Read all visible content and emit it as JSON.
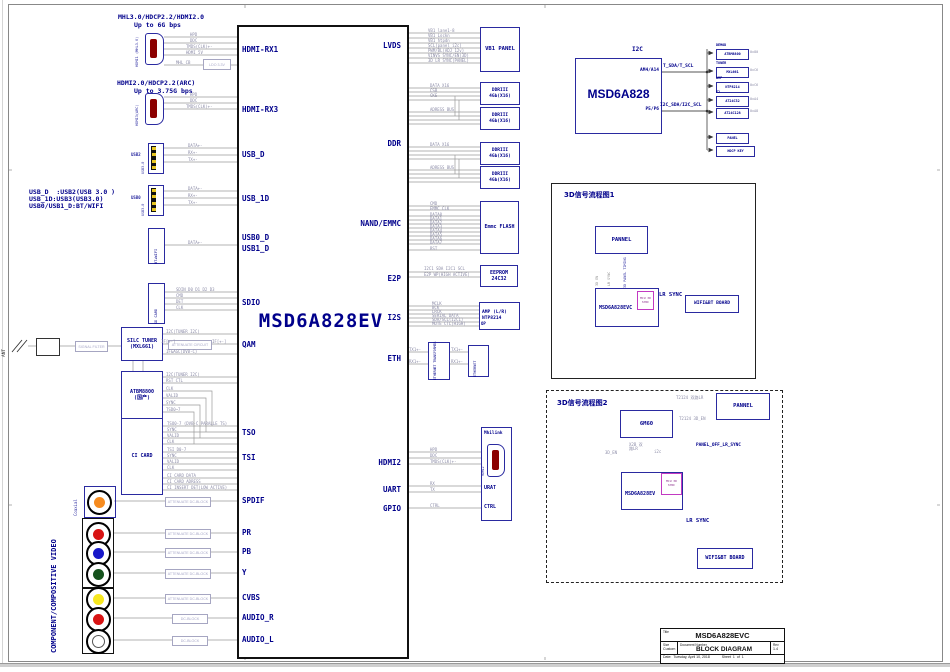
{
  "notes": {
    "mhl1": "MHL3.0/HDCP2.2/HDMI2.0",
    "mhl2": "Up to 6G bps",
    "arc1": "HDMI2.0/HDCP2.2(ARC)",
    "arc2": "Up to 3.75G bps",
    "usb1": "USB_D  :USB2(USB 3.0 )",
    "usb2": "USB_1D:USB3(USB3.0)",
    "usb3": "USB0/USB1_D:BT/WIFI",
    "component": "COMPONENT/COMPOSITIVE VIDEO",
    "coaxial": "Coaxial",
    "ant": "ANT"
  },
  "conn": {
    "hdmi1": "HDMI1 (MHL3.0)",
    "hdmi3": "HDMI3(ARC)",
    "usb2_tag": "USB2",
    "usb2_type": "USB3.0",
    "usb0_tag": "USB0",
    "usb0_type": "USB3.0",
    "btwifi": "BT+WIFI",
    "sdcard": "SD CARD"
  },
  "chip": {
    "label": "MSD6A828EV",
    "pins_left": [
      "HDMI-RX1",
      "HDMI-RX3",
      "USB_D",
      "USB_1D",
      "USB0_D",
      "USB1_D",
      "SDIO",
      "QAM",
      "TSO",
      "TSI",
      "SPDIF",
      "PR",
      "PB",
      "Y",
      "CVBS",
      "AUDIO_R",
      "AUDIO_L"
    ],
    "pins_right": [
      "LVDS",
      "DDR",
      "NAND/EMMC",
      "E2P",
      "I2S",
      "ETH",
      "HDMI2",
      "UART",
      "GPIO"
    ]
  },
  "lw": {
    "hdmi1": [
      "HPD",
      "DDC",
      "TMDS(CLK)+-",
      "HDMI_5V",
      "MHL_CB"
    ],
    "ldo": "LDO 3.3V",
    "hdmi3": [
      "HPD",
      "DDC",
      "TMDS(CLK)+-"
    ],
    "usb": [
      "DATA+-",
      "RX+-",
      "TX+-"
    ],
    "bt": "DATA+-",
    "sd": [
      "SDIN_D0 D1 D2 D3",
      "CMD",
      "DET",
      "CLK"
    ],
    "att": "ATTENUATE  DC-BLOCK",
    "dc": "DC-BLOCK"
  },
  "tuner": {
    "filter": "SIGNAL FILTER",
    "t1": "SILC TUNER",
    "t2": "(MXL661)",
    "d1": "ATBM8800",
    "d2": "(国产)",
    "ci": "CI CARD",
    "attc": "ATTENUATE CIRCUIT",
    "i2c": "I2C(TUNER I2C)",
    "if": "IF[+-]",
    "ifagc": "IF&AGC(DVB-C)",
    "rst": "RST CTL",
    "rows": [
      "CLK",
      "VALID",
      "SYNC",
      "TSD0~7"
    ],
    "tso": [
      "TSO0-7 (DVB-C PARALLE TS)",
      "SYNC",
      "VALID",
      "CLK"
    ],
    "tsi": [
      "TSI D0-7",
      "SYNC",
      "VALID",
      "CLK"
    ],
    "cic": [
      "CI CARD DATA",
      "CI CARD ADRESS",
      "CI INSERT DET(LOW ACTIVE)"
    ]
  },
  "rb": {
    "vb1": "VB1 PANEL",
    "vb1_rows": [
      "VB1 lane1-8",
      "VB1 Lockn",
      "VB1 htpdn",
      "SCL(panel i2c)",
      "PWM/BL(ADJ 12v)",
      "VINVS SYNC/EN(3D)",
      "3D LR SYNC(PANEL)"
    ],
    "ddr1": "DDRIII",
    "ddr2": "4Gb(X16)",
    "ddr_rows": [
      "DATA X16",
      "CSB",
      "CKE",
      "ADRESS BUS"
    ],
    "emmc": "Emmc FLASH",
    "emmc_rows": [
      "CMD",
      "EMMC CLK",
      "DATA0",
      "DATA1",
      "DATA2",
      "DATA3",
      "DATA4",
      "DATA5",
      "DATA6",
      "DATA7",
      "RST"
    ],
    "ee1": "EEPROM",
    "ee2": "24C32",
    "ee_rows": [
      "I2C1 SDA I2C1 SCL",
      "E2P WP(HIGH ACTIVE)"
    ],
    "amp1": "AMP (L/R)",
    "amp2": "NTP8214",
    "op": "OP",
    "amp_rows": [
      "MCLK",
      "BCK",
      "LRCK",
      "SERIAL DATA",
      "SDA/SCL(I2C1)",
      "MUTE CTL(HIGH)"
    ],
    "etr": "ETHERNET TRANSFORMER",
    "eth": "ETHERNET",
    "eth_tx": "TX1+-",
    "eth_rx": "RX1+-",
    "mhi": "Mhilink",
    "mhi_hdmi": "HDMI2",
    "urat": "URAT",
    "ctrl": "CTRL",
    "hdmi2_rows": [
      "HPD",
      "DDC",
      "TMDS(CLK)+-"
    ],
    "uart_rows": [
      "RX",
      "TX"
    ],
    "gpio_row": "CTRL"
  },
  "i2c": {
    "title": "I2C",
    "chip": "MSD6A828",
    "pin_a": "AM4/A14",
    "pin_b": "P5/P6",
    "bus_a": "T_SDA/T_SCL",
    "bus_b": "I2C_SDA/I2C_SCL",
    "devices": [
      {
        "group": "DEMOD",
        "name": "ATBM8800",
        "addr": "0x80"
      },
      {
        "group": "TUNER",
        "name": "MXL661",
        "addr": "0xC6"
      },
      {
        "group": "AMP",
        "name": "NTP8214",
        "addr": "0xC6"
      },
      {
        "group": "E2",
        "name": "AT24C32",
        "addr": "0xA4"
      },
      {
        "group": "",
        "name": "AT24C128",
        "addr": "0xA8"
      }
    ],
    "panel": "PANEL",
    "key": "HDCP KEY"
  },
  "flow1": {
    "title": "3D信号流程图1",
    "pannel": "PANNEL",
    "chip": "MSD6A828EVC",
    "inner": "MCU 3D SYNC",
    "wifi": "WIFI&BT BOARD",
    "up1": "3D EN",
    "up2": "LR SYNC",
    "down": "3D PANEL TIMING",
    "lr": "LR SYNC"
  },
  "flow2": {
    "title": "3D信号流程图2",
    "frc": "6M60",
    "pannel": "PANNEL",
    "chip": "MSD6A828EV",
    "inner": "MCU 3D SYNC",
    "wifi": "WIFI&BT BOARD",
    "a1": "T2124 双路LR",
    "a2": "T2124 3D_EN",
    "u1": "3D_EN",
    "u2": "X2B 双路LR",
    "u3": "i2c",
    "panel_off": "PANEL_OFF_LR_SYNC",
    "lr": "LR SYNC"
  },
  "tb": {
    "title_label": "Title",
    "title": "MSD6A828EVC",
    "size_label": "Size",
    "size": "Custom",
    "doc_label": "Document Number",
    "doc": "BLOCK DIAGRAM",
    "rev_label": "Rev",
    "rev": "1.4",
    "date_label": "Date:",
    "date": "Tuesday, April 10, 2018",
    "sheet_label": "Sheet",
    "sheet": "1",
    "of_label": "of",
    "total": "1"
  }
}
